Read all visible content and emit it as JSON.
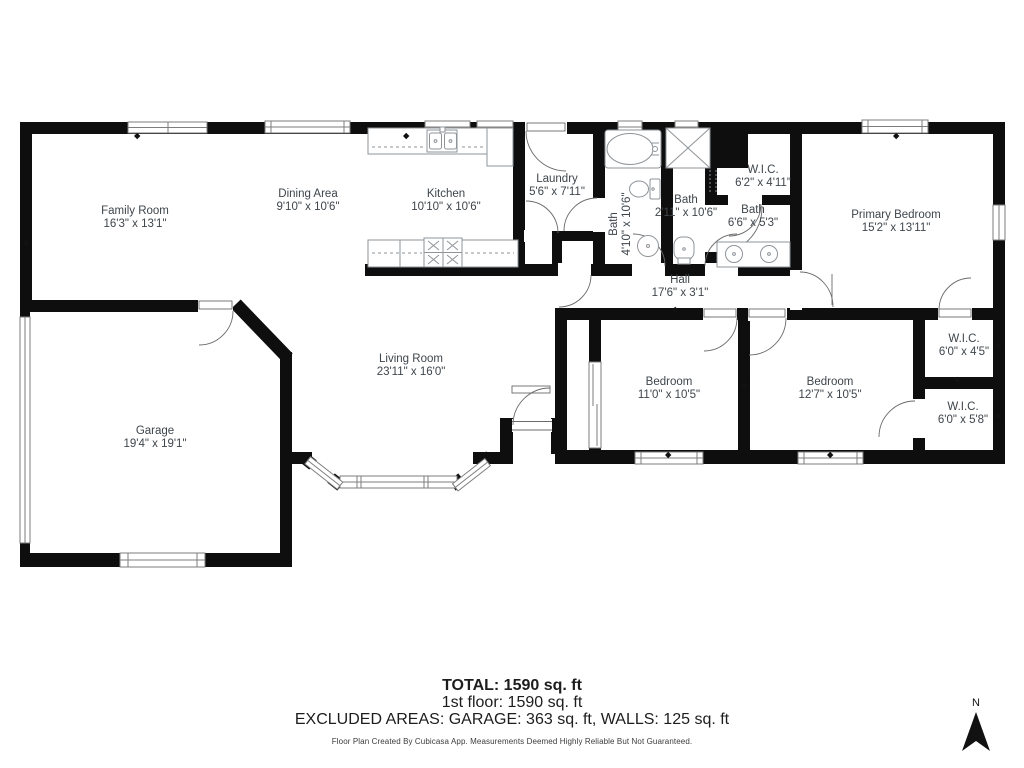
{
  "rooms": [
    {
      "name": "Family Room",
      "dims": "16'3\" x 13'1\""
    },
    {
      "name": "Dining Area",
      "dims": "9'10\" x 10'6\""
    },
    {
      "name": "Kitchen",
      "dims": "10'10\" x 10'6\""
    },
    {
      "name": "Laundry",
      "dims": "5'6\" x 7'11\""
    },
    {
      "name": "Bath",
      "dims": "4'10\" x 10'6\""
    },
    {
      "name": "Bath",
      "dims": "2'11\" x 10'6\""
    },
    {
      "name": "W.I.C.",
      "dims": "6'2\" x 4'11\""
    },
    {
      "name": "Bath",
      "dims": "6'6\" x 5'3\""
    },
    {
      "name": "Primary Bedroom",
      "dims": "15'2\" x 13'11\""
    },
    {
      "name": "Hall",
      "dims": "17'6\" x 3'1\""
    },
    {
      "name": "Living Room",
      "dims": "23'11\" x 16'0\""
    },
    {
      "name": "Garage",
      "dims": "19'4\" x 19'1\""
    },
    {
      "name": "Bedroom",
      "dims": "11'0\" x 10'5\""
    },
    {
      "name": "Bedroom",
      "dims": "12'7\" x 10'5\""
    },
    {
      "name": "W.I.C.",
      "dims": "6'0\" x 4'5\""
    },
    {
      "name": "W.I.C.",
      "dims": "6'0\" x 5'8\""
    }
  ],
  "footer": {
    "total": "TOTAL: 1590 sq. ft",
    "floor": "1st floor: 1590 sq. ft",
    "excluded": "EXCLUDED AREAS: GARAGE: 363 sq. ft, WALLS: 125 sq. ft",
    "disclaimer": "Floor Plan Created By Cubicasa App. Measurements Deemed Highly Reliable But Not Guaranteed."
  },
  "compass": {
    "north_label": "N"
  },
  "colors": {
    "wall_color": "#0e0e0e",
    "label_color": "#3e454b",
    "fixture_line_color": "#8f9499",
    "window_line_color": "#7d7d7d",
    "arc_color": "#6b6b6b"
  }
}
